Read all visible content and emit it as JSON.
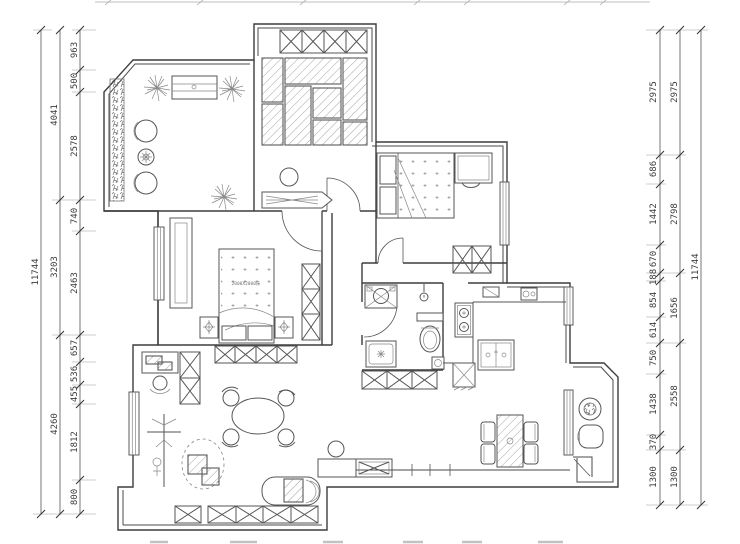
{
  "plan": {
    "bed_label": "2000X2000床"
  },
  "dims": {
    "left": {
      "total": "11744",
      "groups": [
        "4041",
        "3203",
        "4260"
      ],
      "segments": [
        "963",
        "500",
        "2578",
        "740",
        "2463",
        "657",
        "536",
        "455",
        "1812",
        "800"
      ]
    },
    "right": {
      "total": "11744",
      "groups": [
        "2975",
        "2798",
        "1656",
        "2558",
        "1300"
      ],
      "segments": [
        "2975",
        "686",
        "1442",
        "670",
        "188",
        "854",
        "614",
        "750",
        "1438",
        "370",
        "1300"
      ]
    }
  }
}
